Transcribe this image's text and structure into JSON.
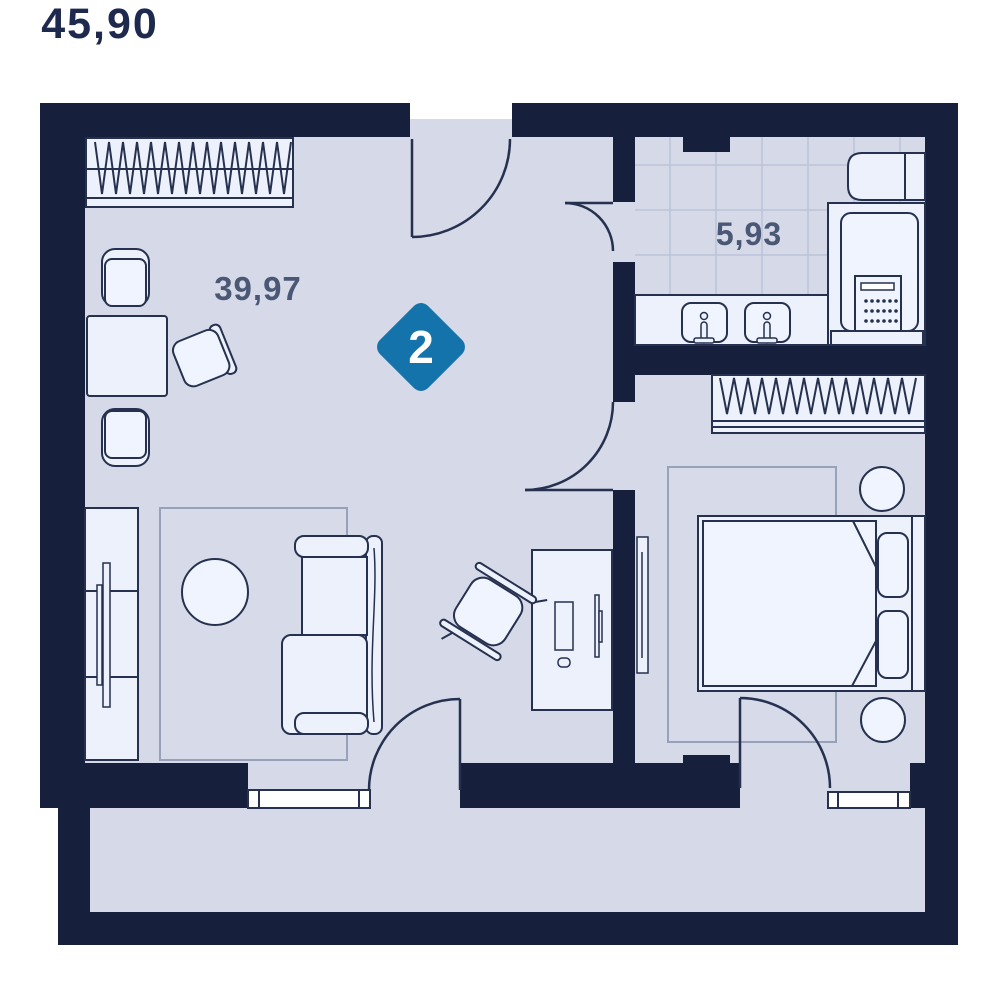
{
  "floorplan": {
    "badge": {
      "rooms_count": "2",
      "total_area": "45,90",
      "color": "#1473AA"
    },
    "areas": {
      "living_room": "39,97",
      "bathroom": "5,93"
    },
    "rooms": [
      {
        "id": "living-room",
        "label": "39,97"
      },
      {
        "id": "bathroom",
        "label": "5,93"
      },
      {
        "id": "bedroom",
        "label": ""
      },
      {
        "id": "hallway",
        "label": ""
      },
      {
        "id": "balcony",
        "label": ""
      }
    ],
    "colors": {
      "wall": "#16203C",
      "floor": "#D5D9E8",
      "furniture_fill": "#EDF1FB",
      "furniture_fill_light": "#F0F4FE",
      "outline": "#25314F",
      "rug_outline": "#98A1BA",
      "tile_line": "#BDC4D7",
      "window_fill": "#FFFFFF",
      "badge_blue": "#1473AA",
      "area_text": "#4B5875",
      "total_text": "#1E2A4D"
    },
    "furniture": [
      "wardrobe",
      "dining-table",
      "dining-chair",
      "sofa",
      "coffee-table",
      "tv-stand",
      "tv",
      "rug",
      "desk",
      "office-chair",
      "monitor",
      "keyboard",
      "mouse",
      "wall-tv",
      "double-bed",
      "pillow",
      "nightstand-lamp",
      "bedroom-wardrobe",
      "bedroom-rug",
      "vanity-counter",
      "sink",
      "washing-machine",
      "bathroom-shelf",
      "window",
      "entrance-door",
      "bathroom-door",
      "bedroom-door",
      "balcony-door"
    ]
  }
}
